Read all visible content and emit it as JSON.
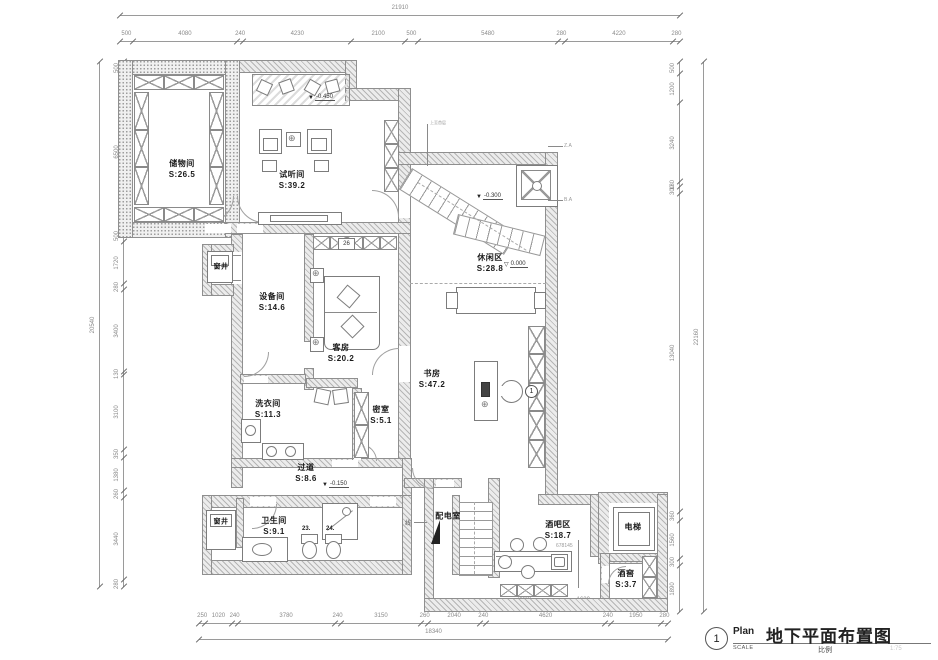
{
  "title_block": {
    "number": "1",
    "plan_label": "Plan",
    "scale_label": "SCALE",
    "title": "地下平面布置图",
    "scale_cn": "比例",
    "scale_value": "1:75"
  },
  "rooms": {
    "storage": {
      "name": "储物间",
      "area": "S:26.5"
    },
    "audio": {
      "name": "试听间",
      "area": "S:39.2"
    },
    "equipment": {
      "name": "设备间",
      "area": "S:14.6"
    },
    "guest": {
      "name": "客房",
      "area": "S:20.2"
    },
    "leisure": {
      "name": "休闲区",
      "area": "S:28.8"
    },
    "study": {
      "name": "书房",
      "area": "S:47.2"
    },
    "laundry": {
      "name": "洗衣间",
      "area": "S:11.3"
    },
    "secret": {
      "name": "密室",
      "area": "S:5.1"
    },
    "corridor": {
      "name": "过道",
      "area": "S:8.6"
    },
    "bathroom": {
      "name": "卫生间",
      "area": "S:9.1"
    },
    "power": {
      "name": "配电室",
      "area": ""
    },
    "bar": {
      "name": "酒吧区",
      "area": "S:18.7"
    },
    "cellar": {
      "name": "酒窖",
      "area": "S:3.7"
    },
    "elevator": {
      "name": "电梯",
      "area": ""
    },
    "window_well_top": {
      "name": "窗井",
      "area": ""
    },
    "window_well_bottom": {
      "name": "窗井",
      "area": ""
    }
  },
  "levels": {
    "audio": "-0.450",
    "hall": "-0.300",
    "leisure": "0.000",
    "corridor": "-0.150"
  },
  "tags": {
    "cabinet": "26",
    "fixture_a": "23.",
    "fixture_b": "24.",
    "detail": "1",
    "bar_note": "678145",
    "leader_a": "Z.A",
    "leader_b": "B.A",
    "power_leader": "线",
    "stair_note": "上至首层"
  },
  "dims": {
    "top": {
      "overall": [
        21910
      ],
      "segments": [
        500,
        4080,
        240,
        4230,
        2100,
        500,
        5480,
        280,
        4220,
        280
      ]
    },
    "bottom": {
      "overall": [
        18340
      ],
      "segments": [
        250,
        1020,
        240,
        3780,
        240,
        3150,
        260,
        2040,
        240,
        4620,
        240,
        1950,
        280
      ],
      "sub": [
        3000,
        1620
      ]
    },
    "left": {
      "overall": [
        20540
      ],
      "segments": [
        500,
        6500,
        500,
        1720,
        280,
        3400,
        130,
        3100,
        350,
        1380,
        260,
        3440,
        280
      ]
    },
    "right": {
      "overall": [
        22160
      ],
      "segments": [
        500,
        1200,
        3240,
        180,
        300,
        13040,
        360,
        1560,
        300,
        1890
      ]
    }
  }
}
